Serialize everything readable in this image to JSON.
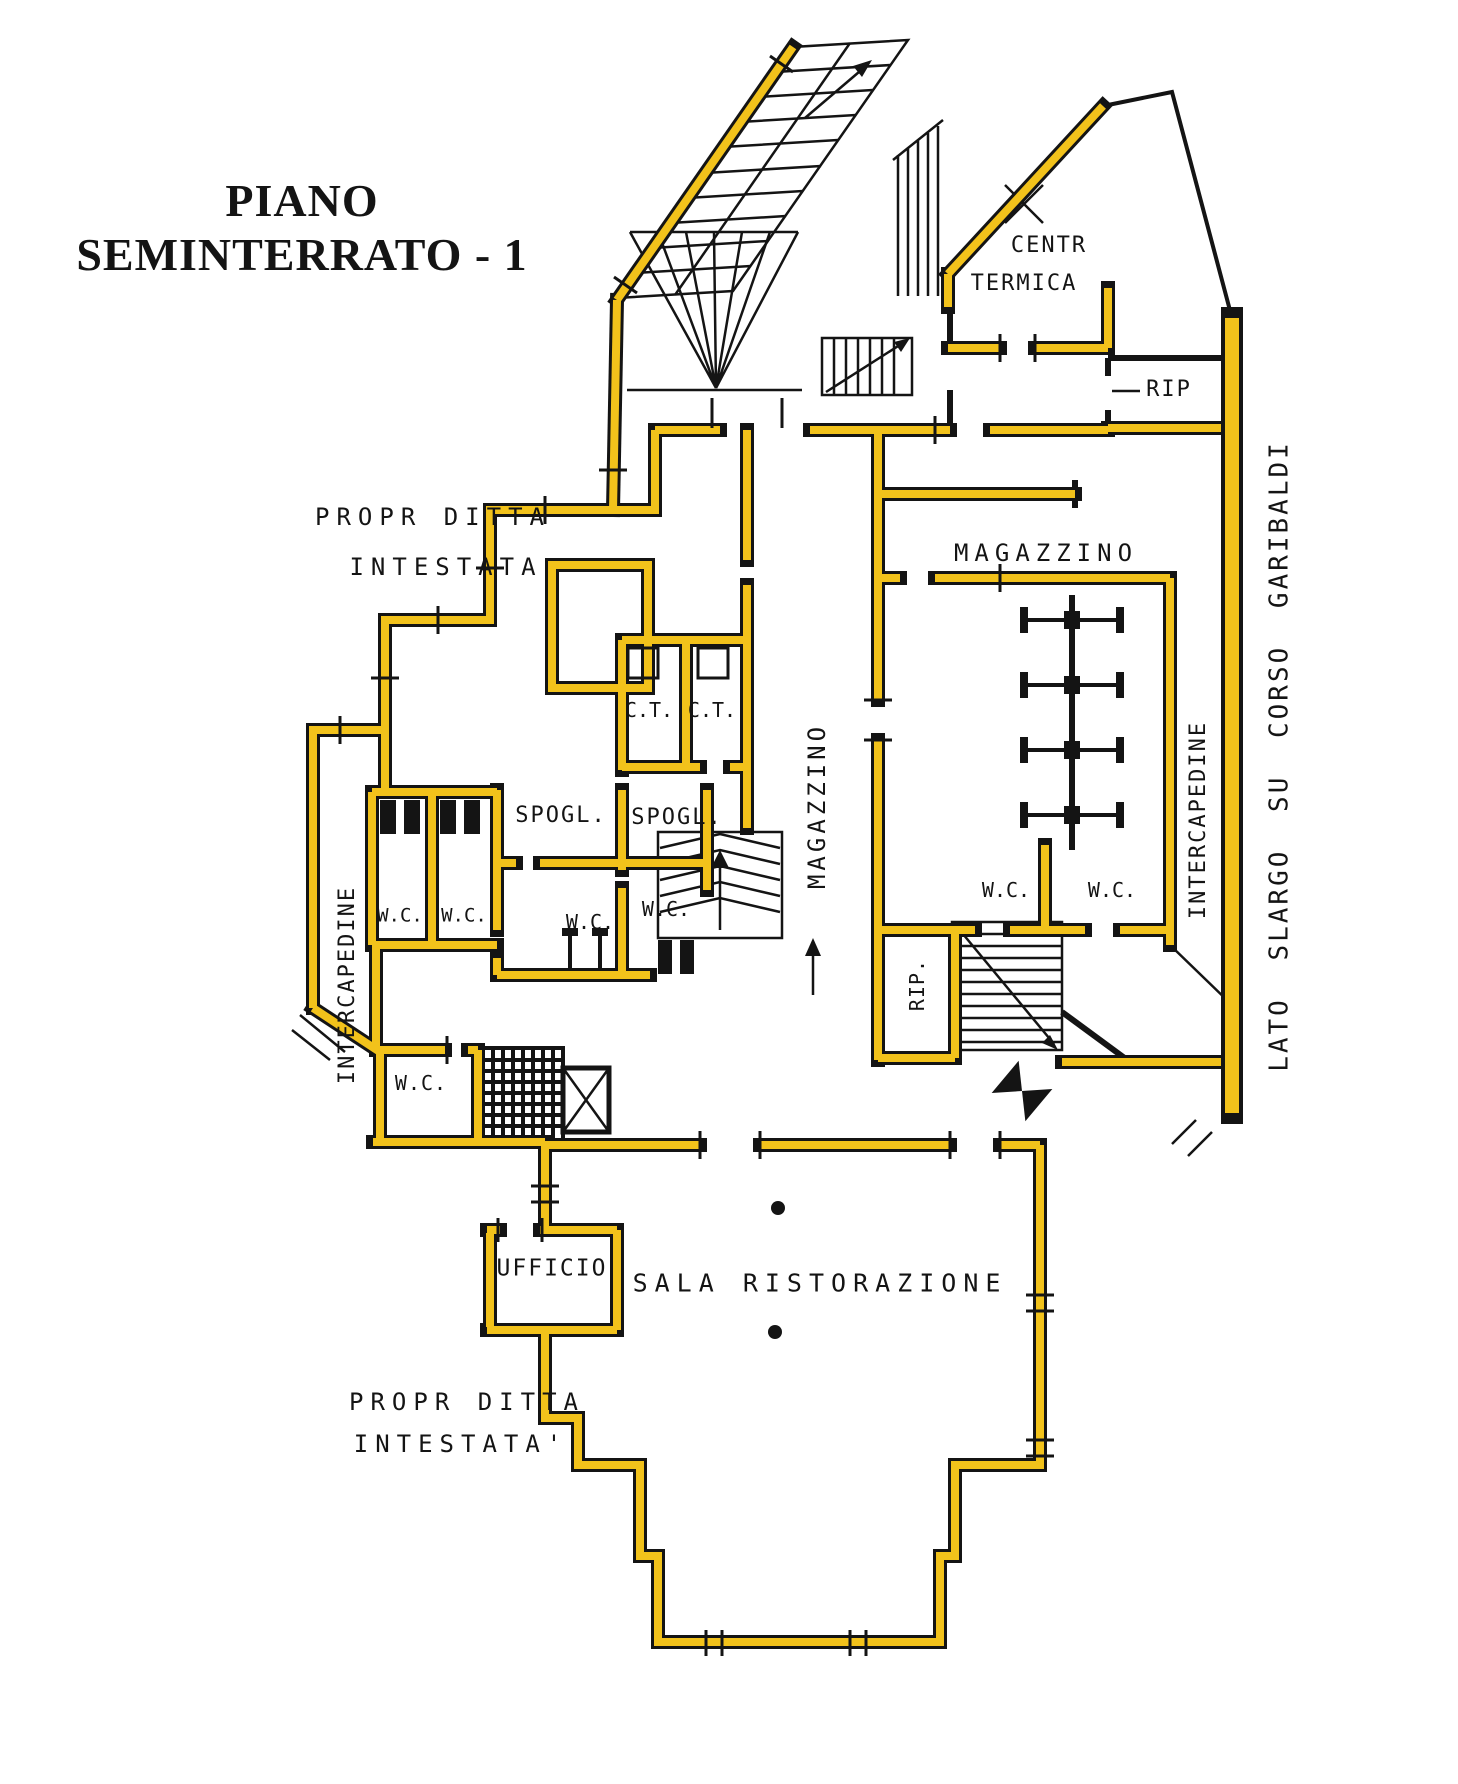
{
  "title": {
    "line1": "PIANO",
    "line2": "SEMINTERRATO - 1"
  },
  "rooms": {
    "centr_termica_line1": "CENTR",
    "centr_termica_line2": "TERMICA",
    "rip_top": "RIP",
    "magazzino_right": "MAGAZZINO",
    "magazzino_corridor": "MAGAZZINO",
    "ct_left": "C.T.",
    "ct_right": "C.T.",
    "spogl_left": "SPOGL.",
    "spogl_right": "SPOGL.",
    "wc_pair_left_1": "W.C.",
    "wc_pair_left_2": "W.C.",
    "wc_center_left": "W.C.",
    "wc_center_right": "W.C.",
    "wc_right_1": "W.C.",
    "wc_right_2": "W.C.",
    "wc_lower_left": "W.C.",
    "rip_middle": "RIP.",
    "ufficio": "UFFICIO",
    "sala_ristorazione": "SALA RISTORAZIONE",
    "intercapedine_left": "INTERCAPEDINE",
    "intercapedine_right": "INTERCAPEDINE"
  },
  "annotations": {
    "propr_top_line1": "PROPR DITTA",
    "propr_top_line2": "INTESTATA",
    "propr_bottom_line1": "PROPR DITTA",
    "propr_bottom_line2": "INTESTATA'",
    "street_side": "LATO SLARGO SU CORSO GARIBALDI"
  },
  "colors": {
    "wall_yellow": "#F2C21B",
    "line_black": "#141414",
    "background": "#FFFFFF"
  }
}
